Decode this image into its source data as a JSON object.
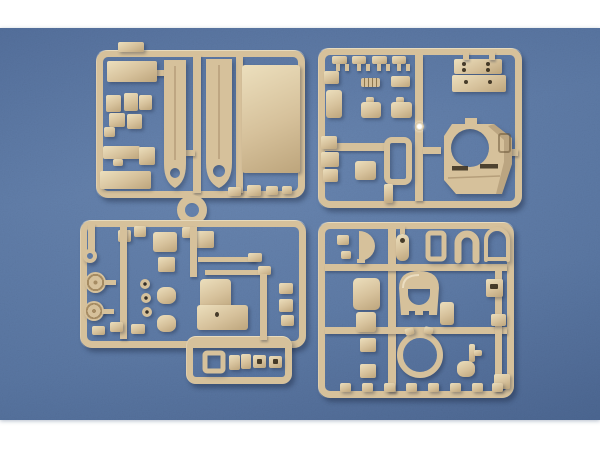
{
  "scene": {
    "kind": "product photo",
    "subject": "four tan plastic model-kit part sprues on a blue fabric backdrop with white bands above and below",
    "regions": [
      {
        "name": "sprue-top-left",
        "contents": "two long hull side panels, large rectangular deck plate, flat hatch panels, small fittings, round sprue-gate ring"
      },
      {
        "name": "sprue-top-right",
        "contents": "turret shell with large round opening, drilled mounting brackets, square hatch panels, row of small clips"
      },
      {
        "name": "sprue-bottom-left",
        "contents": "road wheels, hatch panels, pioneer tools, stepped gun-mount block, small fittings in a lower tab"
      },
      {
        "name": "sprue-bottom-right",
        "contents": "large turret ring, arched mantlet, horseshoe-shaped guards, fan plate, assorted small fittings"
      }
    ],
    "colors": {
      "page_bg": "#ffffff",
      "photo_top": "#52709f",
      "photo_mid": "#5d7caa",
      "photo_mid2": "#5a79a7",
      "photo_bottom": "#4f6c99",
      "plastic": "#d6c19b",
      "plastic_light": "#ecdfbd",
      "plastic_dark": "#a68c63",
      "hole": "rgba(44,34,20,0.85)",
      "shadow": "rgba(22,32,54,0.38)",
      "part_shadow": "rgba(22,32,54,0.32)"
    }
  }
}
